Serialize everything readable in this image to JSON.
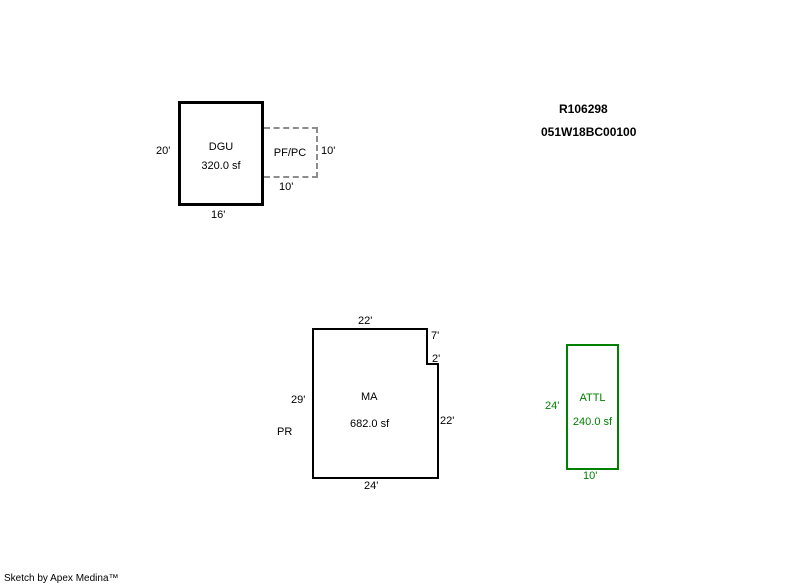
{
  "title_block": {
    "account_id": "R106298",
    "parcel_id": "051W18BC00100"
  },
  "colors": {
    "primary_outline": "#000000",
    "accessory_outline": "#008000",
    "porch_outline_dashed": "#8c8c8c",
    "background": "#ffffff"
  },
  "structures": {
    "dgu": {
      "code": "DGU",
      "area": "320.0 sf",
      "left_dim": "20'",
      "bottom_dim": "16'"
    },
    "pfpc": {
      "code": "PF/PC",
      "right_dim": "10'",
      "bottom_dim": "10'"
    },
    "ma": {
      "code": "MA",
      "area": "682.0 sf",
      "top_dim": "22'",
      "notch_upper_dim": "7'",
      "notch_step_dim": "2'",
      "left_dim": "29'",
      "right_dim": "22'",
      "bottom_dim": "24'",
      "adjacent_label": "PR"
    },
    "attl": {
      "code": "ATTL",
      "area": "240.0 sf",
      "left_dim": "24'",
      "bottom_dim": "10'"
    }
  },
  "footer": {
    "credit": "Sketch by Apex Medina™"
  }
}
